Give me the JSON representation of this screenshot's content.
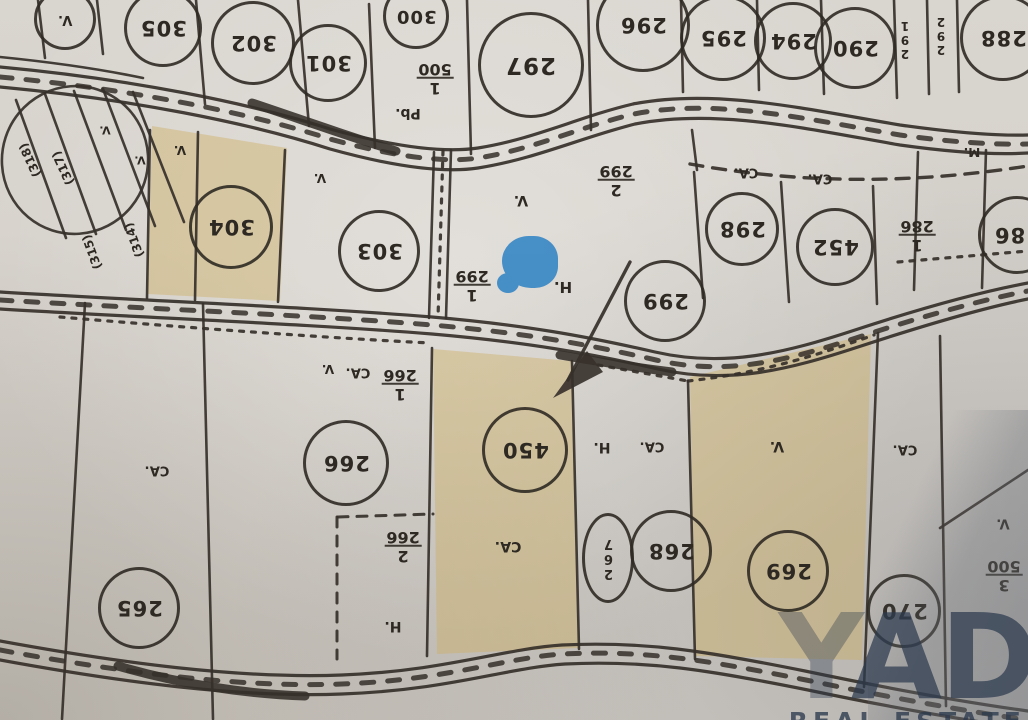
{
  "marker": {
    "color": "#3e8ac6"
  },
  "watermark": {
    "partial_letter": "Y",
    "big_text": "AD",
    "sub_text": "REAL ESTATE",
    "color": "#2c3a4e"
  },
  "map": {
    "shade_color": "rgba(205,173,95,0.42)",
    "ink_color": "#36302a",
    "orientation_note": "map content printed upside-down (rotated 180)",
    "circled_parcels": [
      {
        "n": "V.",
        "x": 62,
        "y": 16,
        "r": 28,
        "fs": 13
      },
      {
        "n": "305",
        "x": 160,
        "y": 25,
        "r": 36
      },
      {
        "n": "302",
        "x": 250,
        "y": 40,
        "r": 39
      },
      {
        "n": "301",
        "x": 325,
        "y": 60,
        "r": 36
      },
      {
        "n": "300",
        "x": 413,
        "y": 13,
        "r": 30,
        "fs": 18
      },
      {
        "n": "297",
        "x": 528,
        "y": 62,
        "r": 50,
        "fs": 23
      },
      {
        "n": "296",
        "x": 640,
        "y": 22,
        "r": 44
      },
      {
        "n": "295",
        "x": 720,
        "y": 35,
        "r": 40
      },
      {
        "n": "294",
        "x": 790,
        "y": 38,
        "r": 36
      },
      {
        "n": "290",
        "x": 852,
        "y": 45,
        "r": 38
      },
      {
        "n": "288",
        "x": 1000,
        "y": 35,
        "r": 40
      },
      {
        "n": "304",
        "x": 228,
        "y": 224,
        "r": 39
      },
      {
        "n": "303",
        "x": 376,
        "y": 248,
        "r": 38
      },
      {
        "n": "299",
        "x": 662,
        "y": 298,
        "r": 38
      },
      {
        "n": "298",
        "x": 739,
        "y": 226,
        "r": 34
      },
      {
        "n": "452",
        "x": 832,
        "y": 244,
        "r": 36
      },
      {
        "n": "286",
        "x": 1014,
        "y": 232,
        "r": 36
      },
      {
        "n": "450",
        "x": 522,
        "y": 447,
        "r": 40
      },
      {
        "n": "266",
        "x": 343,
        "y": 460,
        "r": 40
      },
      {
        "n": "265",
        "x": 136,
        "y": 605,
        "r": 38
      },
      {
        "n": "267",
        "x": 605,
        "y": 555,
        "rx": 23,
        "ry": 42,
        "fs": 13,
        "vert": true
      },
      {
        "n": "268",
        "x": 668,
        "y": 548,
        "r": 38
      },
      {
        "n": "269",
        "x": 785,
        "y": 568,
        "r": 38
      },
      {
        "n": "270",
        "x": 901,
        "y": 608,
        "r": 34
      }
    ],
    "labels": [
      {
        "t": "1/500",
        "x": 435,
        "y": 78
      },
      {
        "t": "Pb.",
        "x": 408,
        "y": 113,
        "fs": 14
      },
      {
        "t": "2/299",
        "x": 616,
        "y": 180
      },
      {
        "t": "V.",
        "x": 521,
        "y": 200,
        "fs": 14
      },
      {
        "t": "1/299",
        "x": 472,
        "y": 285
      },
      {
        "t": "H.",
        "x": 563,
        "y": 287,
        "fs": 15
      },
      {
        "t": "CA.",
        "x": 746,
        "y": 172,
        "fs": 13
      },
      {
        "t": "CA.",
        "x": 820,
        "y": 178,
        "fs": 13
      },
      {
        "t": "M.",
        "x": 972,
        "y": 152,
        "fs": 12
      },
      {
        "t": "1/286",
        "x": 917,
        "y": 235
      },
      {
        "t": "V.",
        "x": 328,
        "y": 369,
        "fs": 12
      },
      {
        "t": "CA.",
        "x": 358,
        "y": 372,
        "fs": 13
      },
      {
        "t": "1/266",
        "x": 400,
        "y": 384
      },
      {
        "t": "CA.",
        "x": 508,
        "y": 546,
        "fs": 14
      },
      {
        "t": "2/266",
        "x": 403,
        "y": 546
      },
      {
        "t": "H.",
        "x": 393,
        "y": 626,
        "fs": 14
      },
      {
        "t": "H.",
        "x": 602,
        "y": 447,
        "fs": 14
      },
      {
        "t": "CA.",
        "x": 652,
        "y": 446,
        "fs": 13
      },
      {
        "t": "V.",
        "x": 777,
        "y": 446,
        "fs": 14
      },
      {
        "t": "CA.",
        "x": 905,
        "y": 449,
        "fs": 13
      },
      {
        "t": "CA.",
        "x": 157,
        "y": 470,
        "fs": 13
      },
      {
        "t": "V.",
        "x": 1003,
        "y": 523,
        "fs": 13
      },
      {
        "t": "3/500",
        "x": 1004,
        "y": 575
      },
      {
        "t": "(314)",
        "x": 134,
        "y": 240,
        "rot": 250,
        "fs": 12
      },
      {
        "t": "(315)",
        "x": 92,
        "y": 252,
        "rot": 250,
        "fs": 12
      },
      {
        "t": "(317)",
        "x": 63,
        "y": 168,
        "rot": 245,
        "fs": 12
      },
      {
        "t": "(318)",
        "x": 30,
        "y": 160,
        "rot": 245,
        "fs": 12
      },
      {
        "t": "V.",
        "x": 105,
        "y": 130,
        "fs": 11
      },
      {
        "t": "V.",
        "x": 140,
        "y": 160,
        "fs": 11
      },
      {
        "t": "V.",
        "x": 180,
        "y": 150,
        "fs": 12
      },
      {
        "t": "V.",
        "x": 320,
        "y": 178,
        "fs": 12
      },
      {
        "t": "291",
        "x": 905,
        "y": 40,
        "fs": 12,
        "vert": true
      },
      {
        "t": "292",
        "x": 941,
        "y": 36,
        "fs": 12,
        "vert": true
      }
    ]
  }
}
